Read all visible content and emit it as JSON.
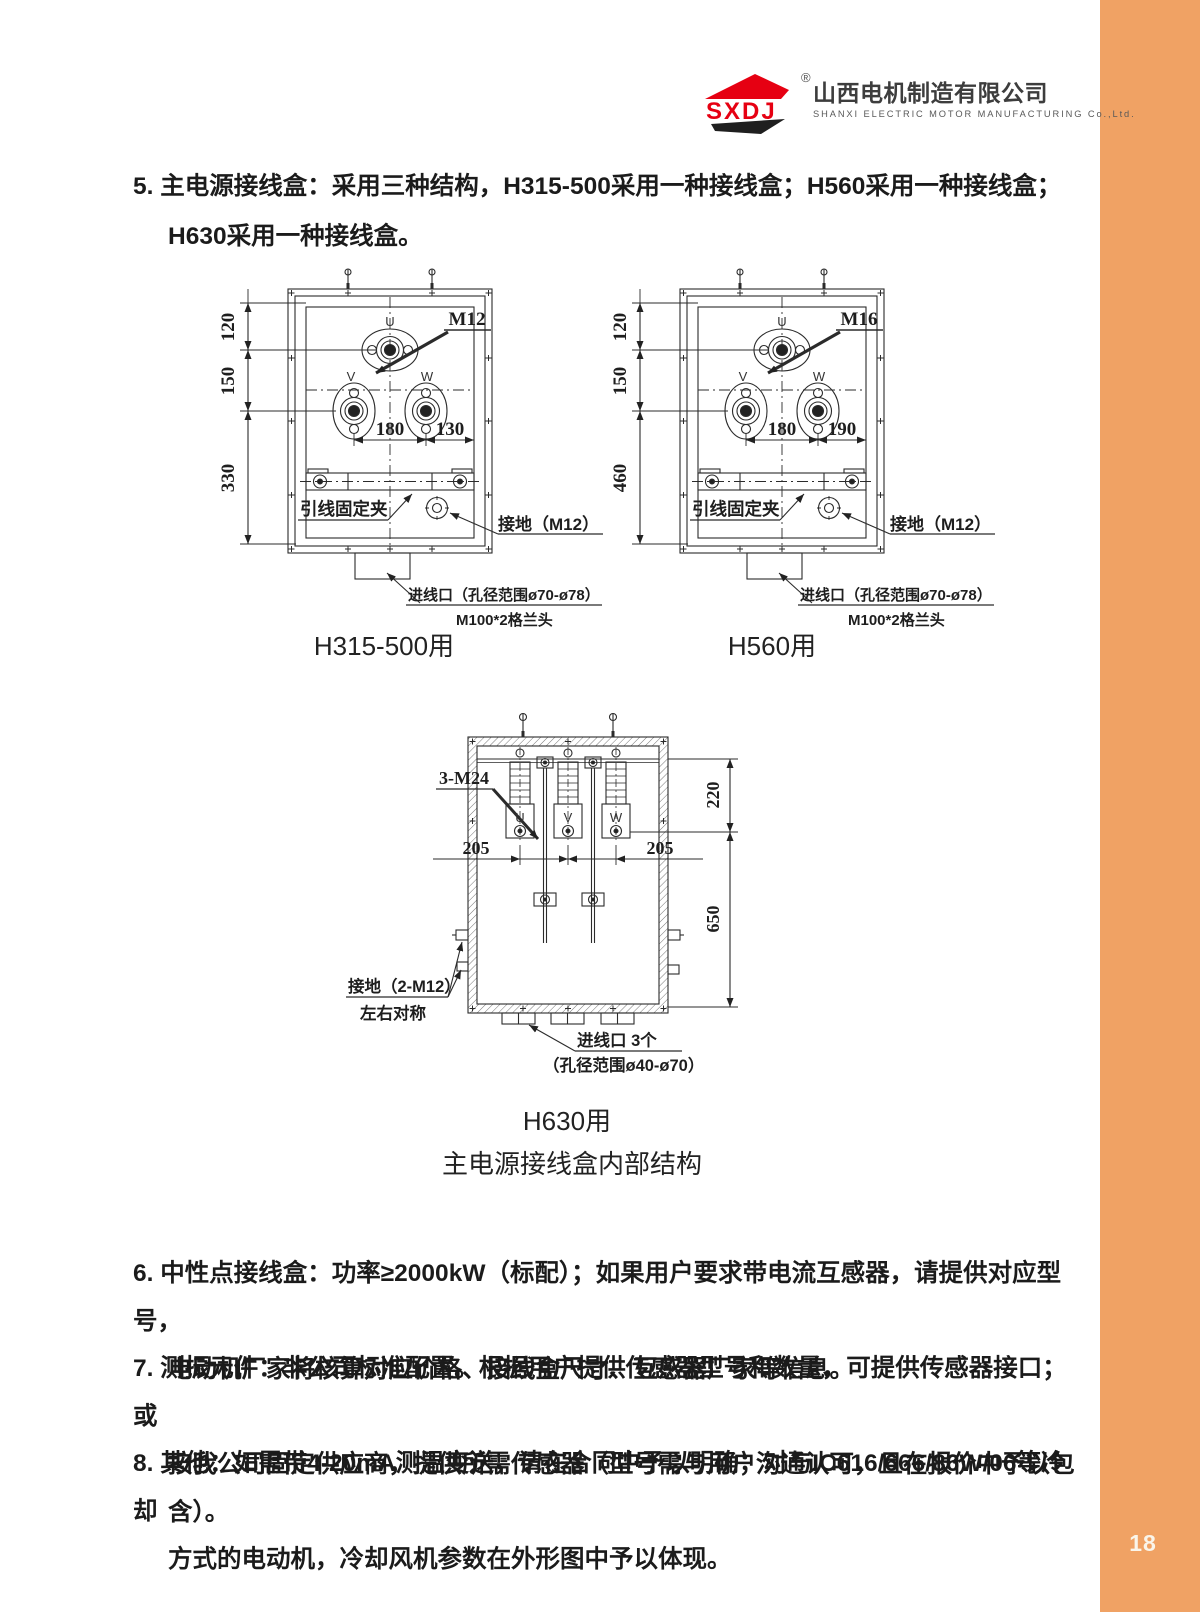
{
  "page": {
    "number": "18"
  },
  "colors": {
    "accent": "#F0A264",
    "logo_red": "#E60012",
    "page_num_ink": "#FAF5EA"
  },
  "logo": {
    "acronym": "SXDJ",
    "registered": "®",
    "company_cn": "山西电机制造有限公司",
    "company_en": "SHANXI ELECTRIC MOTOR MANUFACTURING Co.,Ltd."
  },
  "item5": {
    "line1": "5. 主电源接线盒：采用三种结构，H315-500采用一种接线盒；H560采用一种接线盒；",
    "line2": "H630采用一种接线盒。"
  },
  "box1": {
    "caption": "H315-500用",
    "bolt": "M12",
    "dim_v1": "120",
    "dim_v2": "150",
    "dim_v3": "330",
    "dim_h1": "180",
    "dim_h2": "130",
    "t_u": "U",
    "t_v": "V",
    "t_w": "W",
    "clamp": "引线固定夹",
    "ground": "接地（M12）",
    "entry1": "进线口（孔径范围ø70-ø78）",
    "entry2": "M100*2格兰头"
  },
  "box2": {
    "caption": "H560用",
    "bolt": "M16",
    "dim_v1": "120",
    "dim_v2": "150",
    "dim_v3": "460",
    "dim_h1": "180",
    "dim_h2": "190",
    "t_u": "U",
    "t_v": "V",
    "t_w": "W",
    "clamp": "引线固定夹",
    "ground": "接地（M12）",
    "entry1": "进线口（孔径范围ø70-ø78）",
    "entry2": "M100*2格兰头"
  },
  "box3": {
    "caption": "H630用",
    "label": "3-M24",
    "dim_h1": "205",
    "dim_h2": "205",
    "dim_v1": "220",
    "dim_v2": "650",
    "t_u": "U",
    "t_v": "V",
    "t_w": "W",
    "ground1": "接地（2-M12）",
    "ground2": "左右对称",
    "entry1": "进线口 3个",
    "entry2": "（孔径范围ø40-ø70）"
  },
  "subtitle": "主电源接线盒内部结构",
  "item6": {
    "line1": "6. 中性点接线盒：功率≥2000kW（标配）；如果用户要求带电流互感器，请提供对应型号，",
    "line2": "电动机厂家将核算对应价格、接线盒尺寸、互感器厂家等信息。"
  },
  "item7": {
    "line1": "7. 测振元件：非公司标准配置。根据用户提供传感器型号和数量，可提供传感器接口；或",
    "line2": "按我公司固定供应商，提供所需传感器（型号需与用户沟通认可，且在报价中予以包含）。"
  },
  "item8": {
    "line1": "8. 其他：如需带4-20mA测温变送，请在合同中予以明确；对与IC616/666/86W/06等冷却",
    "line2": "方式的电动机，冷却风机参数在外形图中予以体现。"
  }
}
